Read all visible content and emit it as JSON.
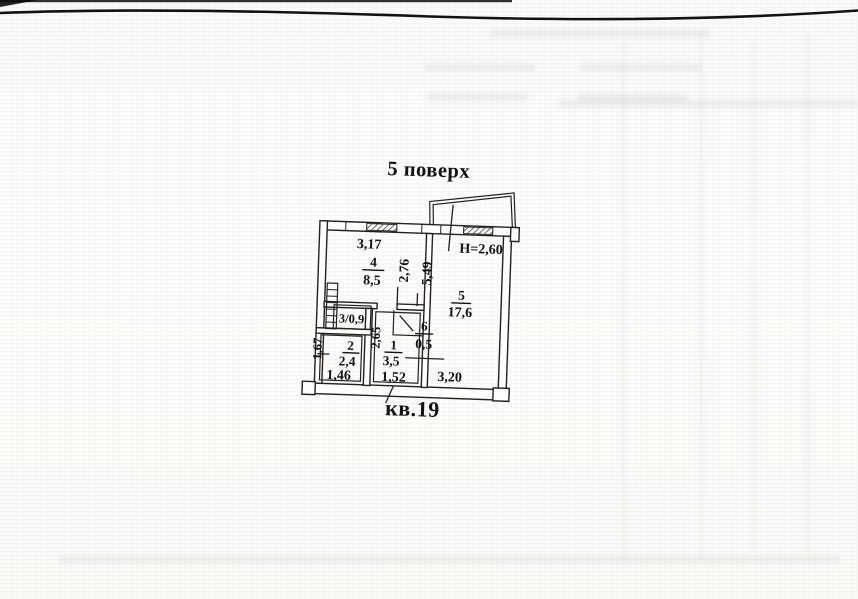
{
  "page": {
    "title": "5 поверх",
    "apartment": "кв.19"
  },
  "plan": {
    "ceiling_height": "H=2,60",
    "rooms": [
      {
        "number": "1",
        "area": "3,5"
      },
      {
        "number": "2",
        "area": "2,4"
      },
      {
        "number": "3",
        "label": "3/0,9"
      },
      {
        "number": "4",
        "area": "8,5"
      },
      {
        "number": "5",
        "area": "17,6"
      },
      {
        "number": "6",
        "area": "0,5"
      }
    ],
    "dimensions": {
      "top_width": "3,17",
      "kitchen_depth": "2,76",
      "living_depth": "5,49",
      "living_bottom_width": "3,20",
      "bath_width_bottom": "1,46",
      "hall_width_bottom": "1,52",
      "bath_depth": "1,67",
      "hall_depth": "2,65"
    }
  }
}
